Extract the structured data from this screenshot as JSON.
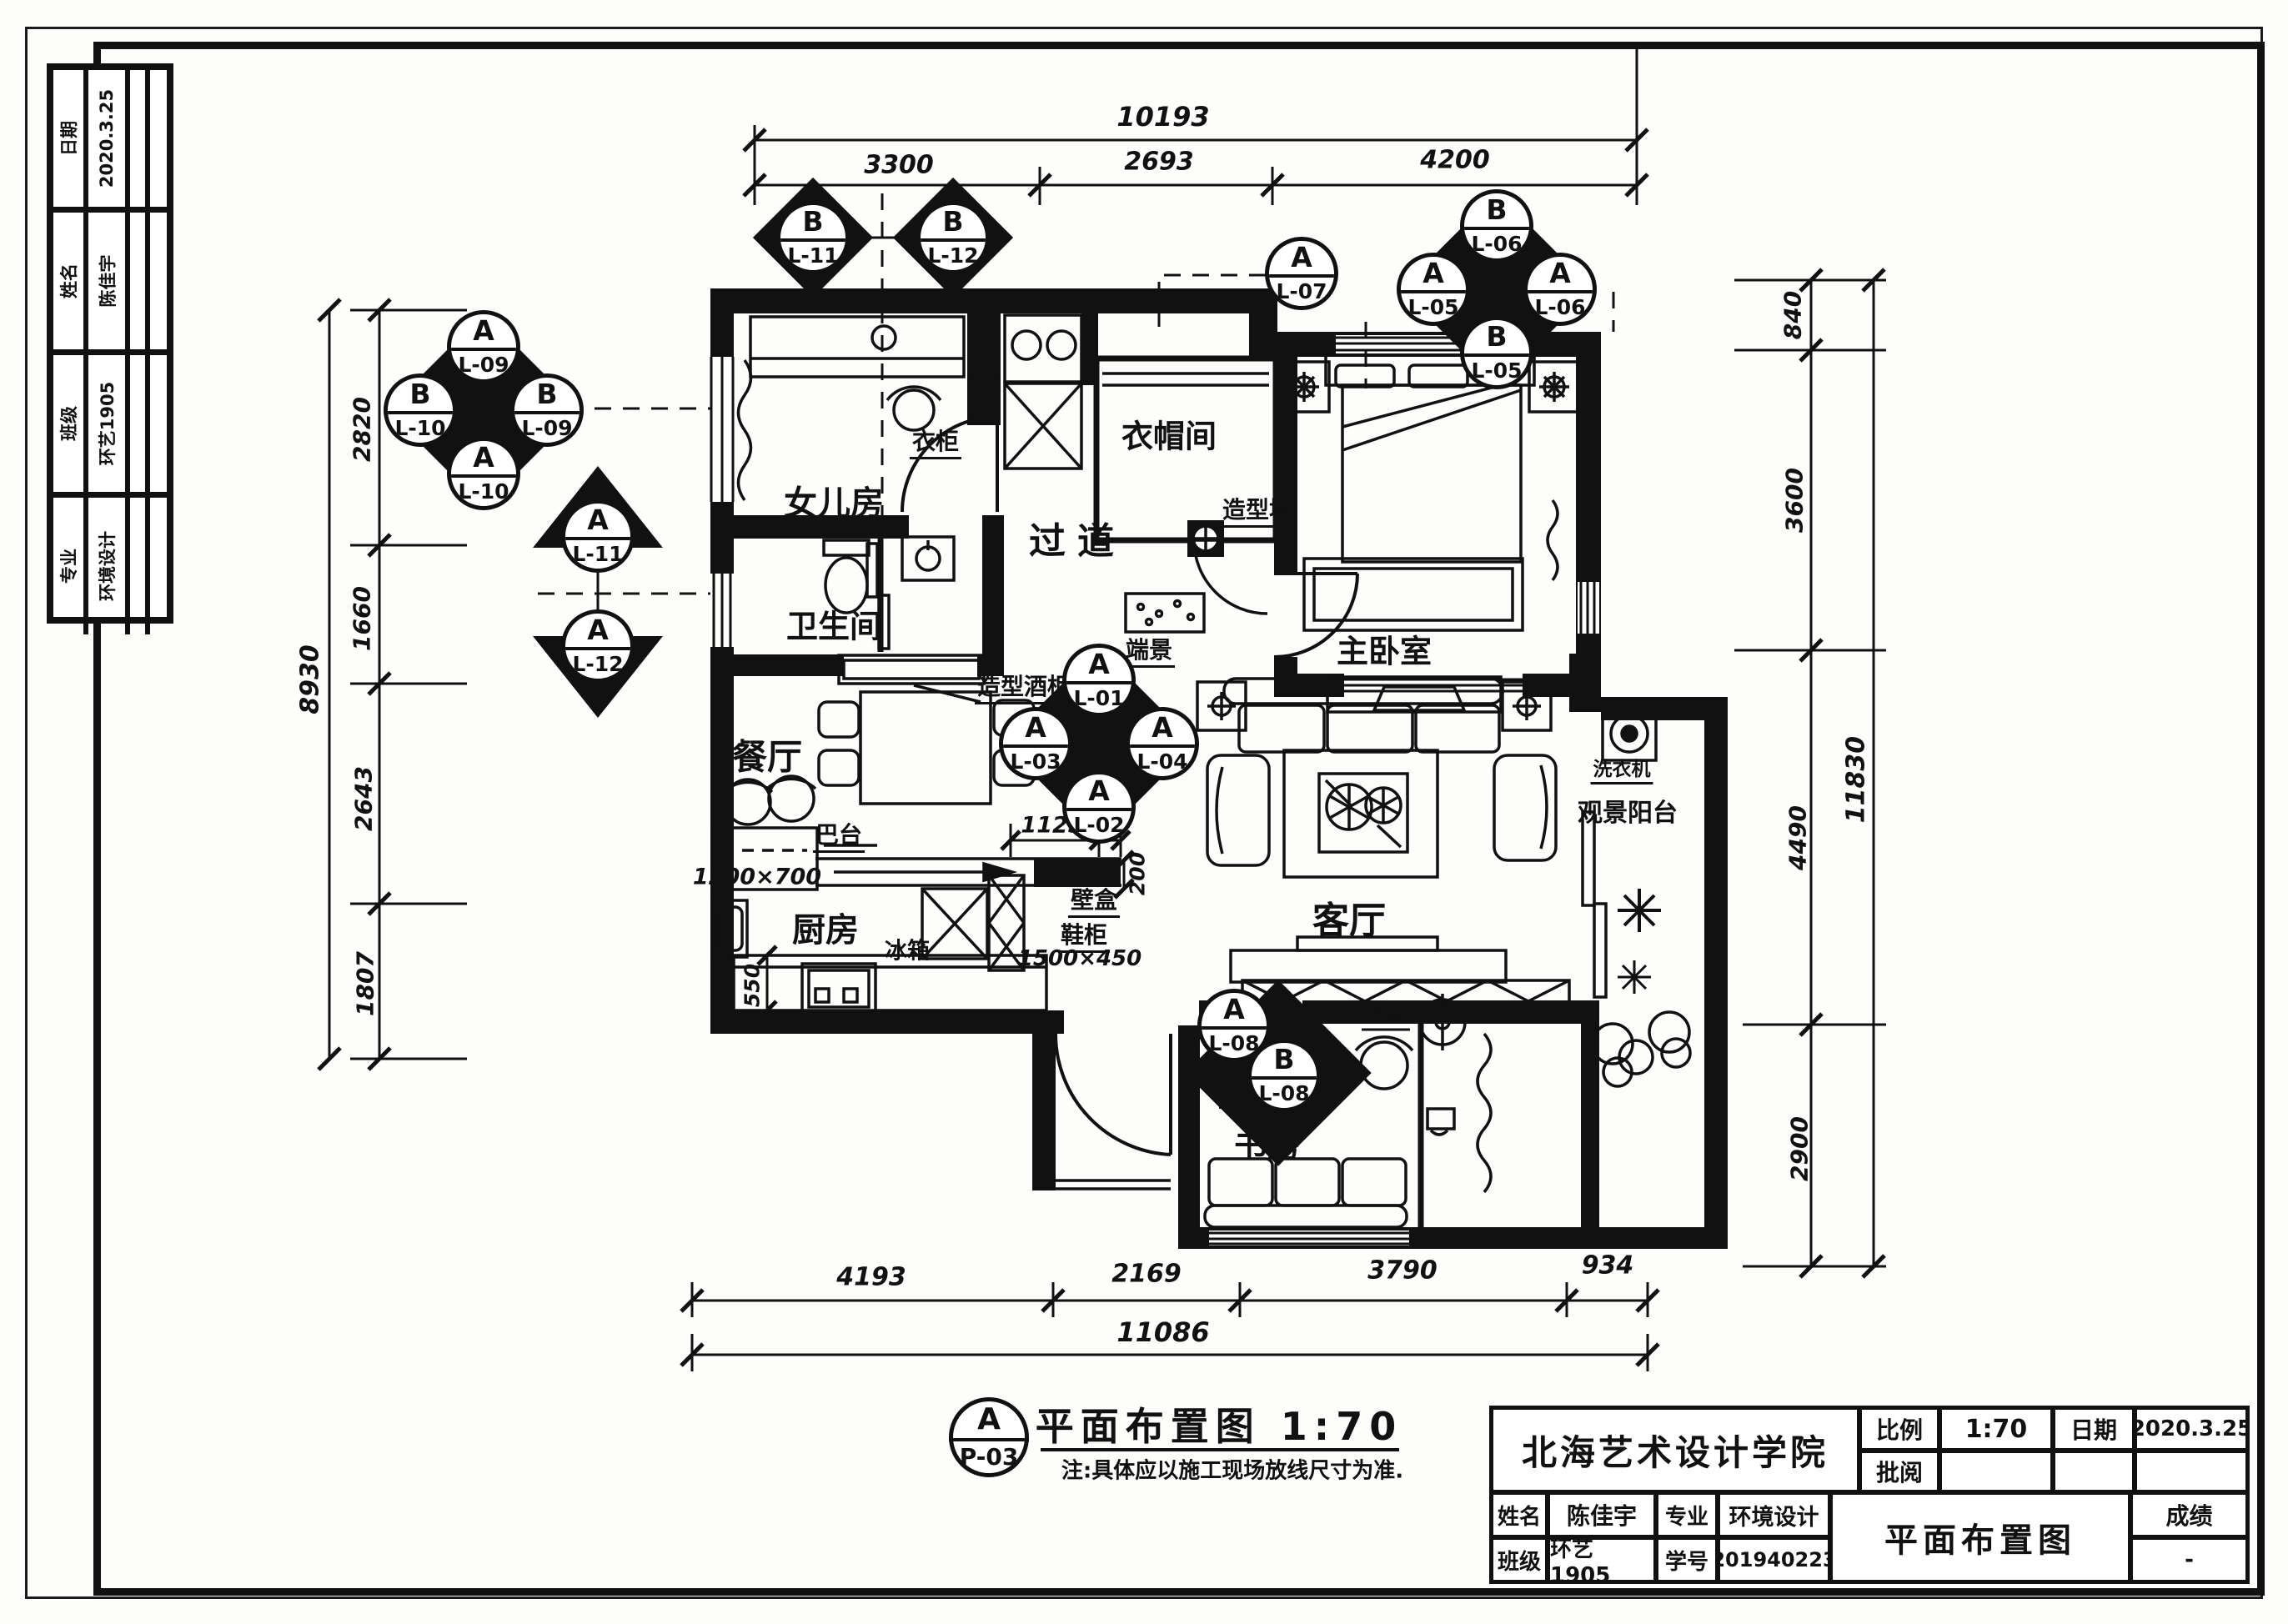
{
  "sheet": {
    "school": "北海艺术设计学院",
    "scale_label": "比例",
    "scale_value": "1:70",
    "date_label": "日期",
    "date_value": "2020.3.25",
    "review_label": "批阅",
    "name_label": "姓名",
    "name_value": "陈佳宇",
    "major_label": "专业",
    "major_value": "环境设计",
    "class_label": "班级",
    "class_value": "环艺1905",
    "id_label": "学号",
    "id_value": "201940223",
    "grade_label": "成绩",
    "grade_value": "-",
    "drawing_name": "平面布置图"
  },
  "revision_table": {
    "rows": [
      {
        "label": "日期",
        "value": "2020.3.25"
      },
      {
        "label": "姓名",
        "value": "陈佳宇"
      },
      {
        "label": "班级",
        "value": "环艺1905"
      },
      {
        "label": "专业",
        "value": "环境设计"
      }
    ]
  },
  "drawing_title": {
    "tag_letter": "A",
    "tag_code": "P-03",
    "title": "平面布置图 1:70",
    "note": "注:具体应以施工现场放线尺寸为准."
  },
  "rooms": {
    "daughter": "女儿房",
    "bath": "卫生间",
    "corridor": "过道",
    "closet": "衣帽间",
    "master": "主卧室",
    "dining": "餐厅",
    "kitchen": "厨房",
    "living": "客厅",
    "study": "书房",
    "balcony": "观景阳台"
  },
  "furniture": {
    "wardrobe": "衣柜",
    "feature_wall": "造型墙",
    "end_view": "端景",
    "wine_cabinet": "造型酒柜",
    "bar": "巴台",
    "bar_size": "1200×700",
    "fridge": "冰箱",
    "niche": "壁盒",
    "shoe_cabinet": "鞋柜",
    "shoe_size": "1500×450",
    "bookcase": "书柜",
    "washer": "洗衣机"
  },
  "dims": {
    "top": {
      "total": "10193",
      "s0": "3300",
      "s1": "2693",
      "s2": "4200"
    },
    "left": {
      "total": "8930",
      "s0": "2820",
      "s1": "1660",
      "s2": "2643",
      "s3": "1807"
    },
    "right": {
      "total": "11830",
      "s0": "840",
      "s1": "3600",
      "s2": "4490",
      "s3": "2900"
    },
    "bottom": {
      "total": "11086",
      "s0": "4193",
      "s1": "2169",
      "s2": "3790",
      "s3": "934"
    },
    "inner": {
      "d1125": "1125",
      "d240": "240",
      "d200": "200",
      "d550": "550"
    }
  },
  "markers": {
    "left4": {
      "top": {
        "letter": "A",
        "code": "L-09"
      },
      "left": {
        "letter": "B",
        "code": "L-10"
      },
      "right": {
        "letter": "B",
        "code": "L-09"
      },
      "bottom": {
        "letter": "A",
        "code": "L-10"
      }
    },
    "topright4": {
      "top": {
        "letter": "B",
        "code": "L-06"
      },
      "left": {
        "letter": "A",
        "code": "L-05"
      },
      "right": {
        "letter": "A",
        "code": "L-06"
      },
      "bottom": {
        "letter": "B",
        "code": "L-05"
      }
    },
    "center4": {
      "top": {
        "letter": "A",
        "code": "L-01"
      },
      "left": {
        "letter": "A",
        "code": "L-03"
      },
      "right": {
        "letter": "A",
        "code": "L-04"
      },
      "bottom": {
        "letter": "A",
        "code": "L-02"
      }
    },
    "b11": {
      "letter": "B",
      "code": "L-11"
    },
    "b12": {
      "letter": "B",
      "code": "L-12"
    },
    "a11": {
      "letter": "A",
      "code": "L-11"
    },
    "a12": {
      "letter": "A",
      "code": "L-12"
    },
    "a07": {
      "letter": "A",
      "code": "L-07"
    },
    "a08": {
      "letter": "A",
      "code": "L-08"
    },
    "b08": {
      "letter": "B",
      "code": "L-08"
    }
  },
  "colors": {
    "ink": "#111111",
    "paper": "#fdfdfc"
  }
}
